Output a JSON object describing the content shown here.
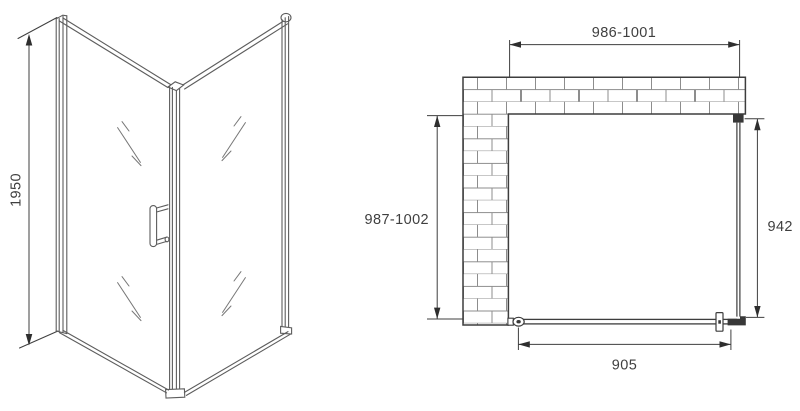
{
  "drawing": {
    "views": {
      "perspective": {
        "label": "3d-corner-view",
        "height_dimension": "1950"
      },
      "plan": {
        "label": "top-plan-view",
        "top_width_dimension": "986-1001",
        "left_depth_dimension": "987-1002",
        "right_depth_dimension": "942",
        "door_width_dimension": "905"
      }
    },
    "colors": {
      "background": "#ffffff",
      "plan_line": "#3d3d3d",
      "structure_line": "#5d5d5d",
      "glass_mark_line": "#777777",
      "brick_line": "#8d8d8d",
      "dimension_line": "#3f3f3f",
      "solid_fitting": "#383838",
      "text": "#3f3f3f"
    }
  }
}
